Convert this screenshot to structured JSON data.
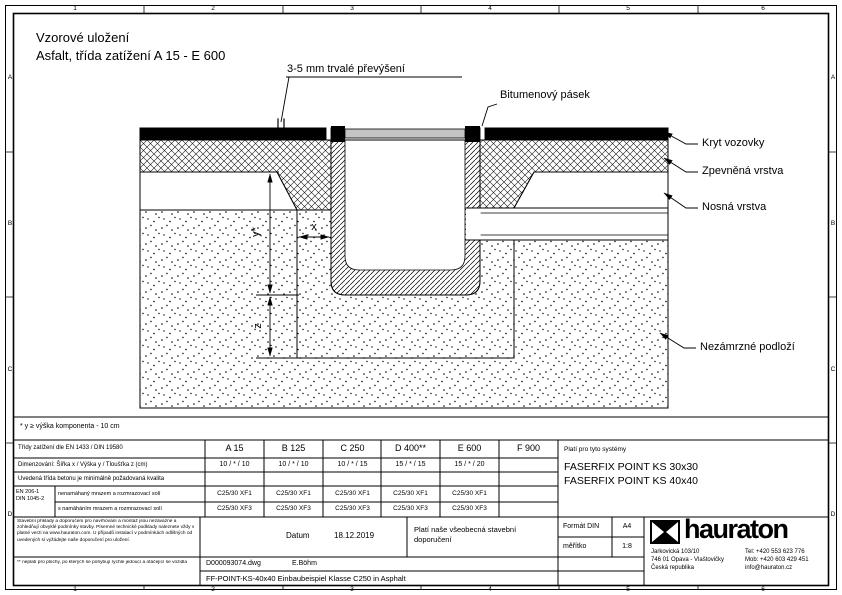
{
  "frame": {
    "cols": [
      "1",
      "2",
      "3",
      "4",
      "5",
      "6"
    ],
    "rows": [
      "A",
      "B",
      "C",
      "D"
    ]
  },
  "title": {
    "line1": "Vzorové uložení",
    "line2": "Asfalt, třída zatížení A 15 - E 600"
  },
  "annotations": {
    "overhang": "3-5 mm trvalé převýšení",
    "bitumen": "Bitumenový pásek",
    "layer_surface": "Kryt vozovky",
    "layer_base": "Zpevněná vrstva",
    "layer_bearing": "Nosná vrstva",
    "subsoil": "Nezámrzné podloží"
  },
  "dims": {
    "x": "x",
    "y": "y*",
    "z": "z"
  },
  "footnote_y": "* y ≥ výška komponenta - 10 cm",
  "table": {
    "load_class_label": "Třídy zatížení dle EN 1433 / DIN 19580",
    "classes": [
      "A 15",
      "B 125",
      "C 250",
      "D 400**",
      "E 600",
      "F 900"
    ],
    "dim_label": "Dimenzování:  Šířka x / Výška y / Tloušťka z (cm)",
    "dims": [
      "10 / * / 10",
      "10 / * / 10",
      "10 / * / 15",
      "15 / * / 15",
      "15 / * / 20",
      ""
    ],
    "concrete_note": "Uvedená třída betonu je minimálně požadovaná kvalita",
    "norm1": "EN 206-1",
    "norm2": "DIN 1045-2",
    "xf1_label": "nenamáhaný mrazem a rozmrazovací solí",
    "xf1": [
      "C25/30 XF1",
      "C25/30 XF1",
      "C25/30 XF1",
      "C25/30 XF1",
      "C25/30 XF1",
      ""
    ],
    "xf3_label": "s namáháním mrazem a rozmrazovací solí",
    "xf3": [
      "C25/30 XF3",
      "C25/30 XF3",
      "C25/30 XF3",
      "C25/30 XF3",
      "C25/30 XF3",
      ""
    ]
  },
  "systems": {
    "heading": "Platí pro tyto systémy",
    "items": [
      "FASERFIX POINT KS 30x30",
      "FASERFIX POINT KS 40x40"
    ]
  },
  "titleblock": {
    "disclaimer": "Stavební příklady a doporučení pro navrhování a montáž jsou nezávazné a zohledňují obvyklé podmínky stavby. Písemné technické podklady naleznete vždy v platné verzi na www.hauraton.com. U případů instalací v podmínkách odlišných od uvedených si vyžádejte naše doporučení pro uložení.",
    "date_label": "Datum",
    "date": "18.12.2019",
    "note": "Platí naše všeobecná stavební doporučení",
    "format_label": "Formát DIN",
    "format": "A4",
    "scale_label": "měřítko",
    "scale": "1:8",
    "footnote2": "** neplatí pro plochy, po kterých se pohybují rychle jedoucí a otáčející se vozidla",
    "file": "D000093074.dwg",
    "author": "E.Böhm",
    "doc_title": "FF-POINT-KS-40x40 Einbaubeispiel Klasse C250 in Asphalt",
    "brand": "hauraton",
    "address": [
      "Jarkovická 103/10",
      "746 01 Opava - Vlaštovičky",
      "Česká republika"
    ],
    "contact": [
      "Tel: +420 553 623 776",
      "Mob: +420 603 429 451",
      "info@hauraton.cz"
    ]
  },
  "colors": {
    "grate": "#c4c4c4",
    "line": "#000000"
  }
}
